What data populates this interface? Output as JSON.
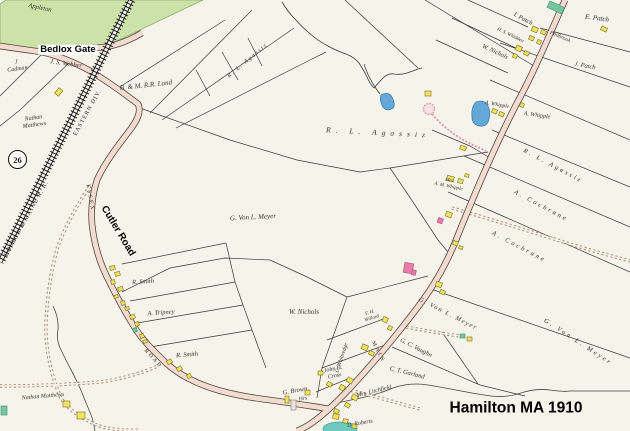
{
  "annotations": {
    "bedlox": "Bedlox Gate",
    "cutler": "Cutler Road",
    "title": "Hamilton MA 1910",
    "marker": "26"
  },
  "railroad": {
    "name": "BOSTON & MAINE R. R.",
    "division": "EASTERN DIV."
  },
  "road_names": {
    "essex": "ESSEX",
    "road": "ROAD",
    "main": "MAIN"
  },
  "owners": {
    "appleton": "Appleton",
    "cadman": "J\nCadman",
    "webber": "J. S. Webber",
    "bm_land": "B. & M. R.R. Land",
    "matthews_two_line": "Nathan\nMatthews",
    "matthews_one_line": "Nathan Matthews",
    "agassiz": "R. L. Agassiz",
    "meyer": "G. Von L. Meyer",
    "cochrane": "A. Cochrane",
    "nichols": "W. Nichols",
    "smith": "R. Smith",
    "tripney": "A. Tripney",
    "brown": "G. Brown",
    "brown_hrs": "Hrs",
    "cross": "John H.\nCross",
    "whittredge": "C. Whittredge",
    "litchfield": "Mrs. Litchfield",
    "roberts": "D. Roberts",
    "vaughn": "G. C. Vaughn",
    "garland": "C. T. Garland",
    "willard": "F. H.\nWillard",
    "whipple_a": "A. Whipple",
    "whipple_mrs": "Mrs.\nA. M. Whipple",
    "patch_i": "I. Patch",
    "patch_e": "E. Patch",
    "patch_j": "J. Patch",
    "whidden": "H. S. Whidden",
    "philbrook": "Philbrook"
  },
  "colors": {
    "paper": "#f6f3ea",
    "road_fill": "#f2dcd1",
    "railroad": "#1a1a1e",
    "water": "#64a8d8",
    "water_teal": "#6fc9bd",
    "building_wood": "#efe262",
    "building_special": "#74c6a0",
    "building_brick": "#e87ba8",
    "vegetation": "#cde2a9",
    "trail": "#a98f76",
    "drive_pink": "#d895aa"
  }
}
